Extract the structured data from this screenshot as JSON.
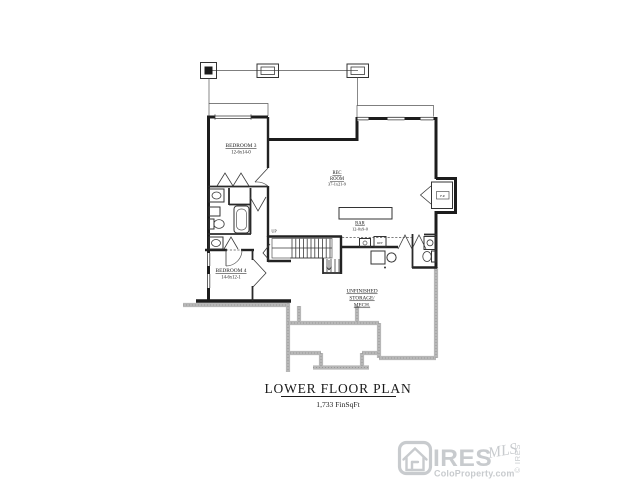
{
  "title": {
    "text": "LOWER FLOOR PLAN",
    "subtitle": "1,733 FinSqFt"
  },
  "rooms": {
    "bedroom3": {
      "name": "BEDROOM 3",
      "dims": "12-6x14-0"
    },
    "rec_room": {
      "name1": "REC",
      "name2": "ROOM",
      "dims": "37-1x21-9"
    },
    "bar": {
      "name": "BAR",
      "dims": "12-0x9-0"
    },
    "bedroom4": {
      "name": "BEDROOM 4",
      "dims": "14-6x12-1"
    },
    "storage": {
      "line1": "UNFINISHED",
      "line2": "STORAGE/",
      "line3": "MECH."
    }
  },
  "annotations": {
    "stairs": "UP",
    "fireplace": "F.P.",
    "fridge": "REF"
  },
  "watermark": {
    "brand": "IRES",
    "script": "MLS",
    "site": "ColoProperty.com",
    "vertical": "© IRES"
  },
  "colors": {
    "wall": "#1c1c1c",
    "foundation": "#b7b7b7",
    "label": "#1a1a1a",
    "watermark": "#c8cbce",
    "background": "#ffffff"
  }
}
